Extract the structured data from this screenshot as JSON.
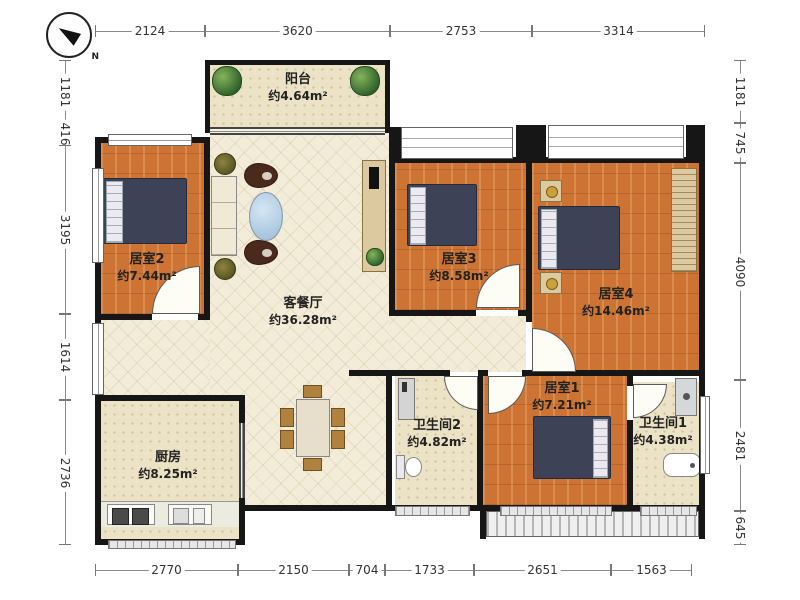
{
  "compass": {
    "north_label": "N"
  },
  "rooms": {
    "balcony": {
      "name": "阳台",
      "area": "约4.64m²"
    },
    "living": {
      "name": "客餐厅",
      "area": "约36.28m²"
    },
    "bedroom1": {
      "name": "居室1",
      "area": "约7.21m²"
    },
    "bedroom2": {
      "name": "居室2",
      "area": "约7.44m²"
    },
    "bedroom3": {
      "name": "居室3",
      "area": "约8.58m²"
    },
    "bedroom4": {
      "name": "居室4",
      "area": "约14.46m²"
    },
    "bath1": {
      "name": "卫生间1",
      "area": "约4.38m²"
    },
    "bath2": {
      "name": "卫生间2",
      "area": "约4.82m²"
    },
    "kitchen": {
      "name": "厨房",
      "area": "约8.25m²"
    }
  },
  "dimensions": {
    "top": [
      "2124",
      "3620",
      "2753",
      "3314"
    ],
    "bottom": [
      "2770",
      "2150",
      "704",
      "1733",
      "2651",
      "1563"
    ],
    "left": [
      "1181",
      "416",
      "3195",
      "1614",
      "2736"
    ],
    "right": [
      "1181",
      "745",
      "4090",
      "2481",
      "645"
    ]
  },
  "colors": {
    "wall": "#161616",
    "wood_floor": "#cd7434",
    "tile_floor": "#ece3c6",
    "living_floor": "#f2ecd8",
    "bed": "#3d4257",
    "coffee_table": "#bcd6ea"
  }
}
